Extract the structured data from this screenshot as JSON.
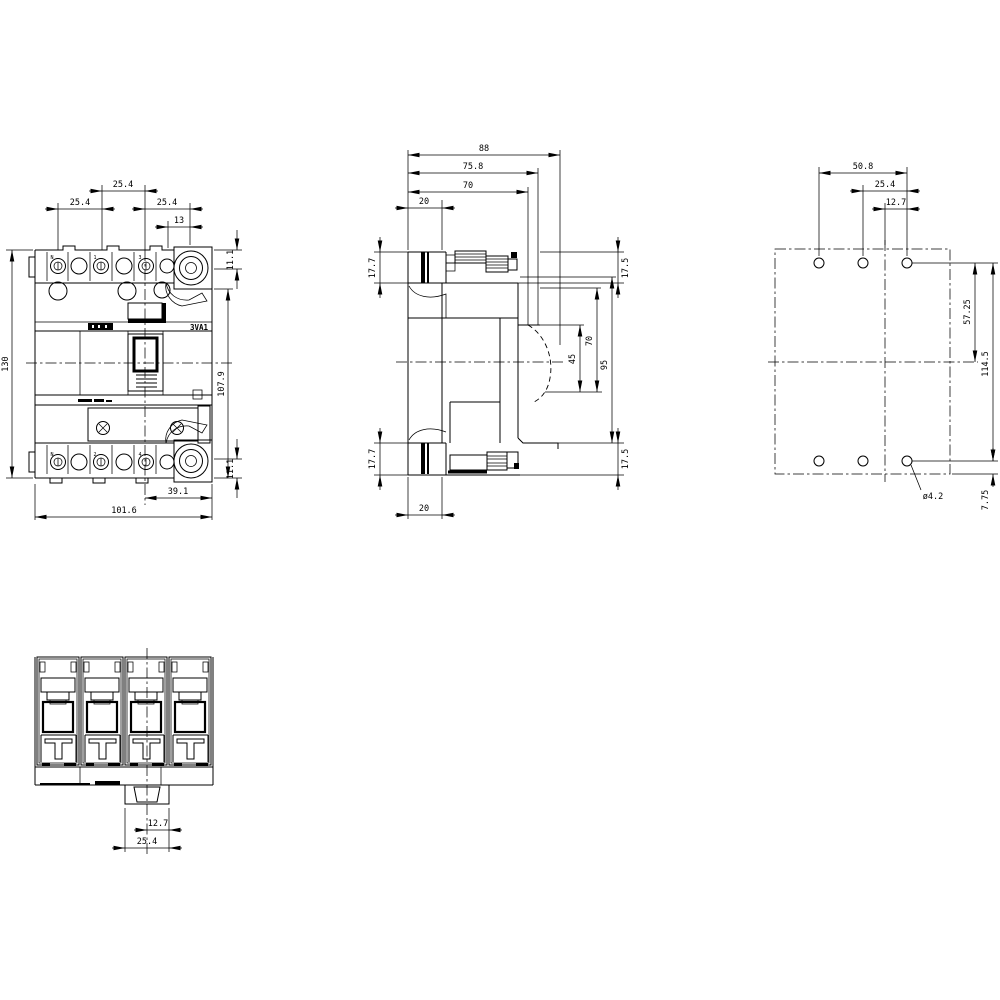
{
  "drawing": {
    "product_label": "3VA1"
  },
  "dims": {
    "front": {
      "pitch_top": "25.4",
      "pitch_left": "25.4",
      "pitch_right": "25.4",
      "rotary_offset": "13",
      "rotary_height_top": "11.1",
      "rotary_height_bottom": "11.1",
      "overall_height": "130",
      "face_height": "107.9",
      "bottom_offset": "39.1",
      "overall_width": "101.6"
    },
    "side": {
      "overall_depth": "88",
      "escutcheon_depth": "75.8",
      "front_depth": "70",
      "terminal_depth_top": "20",
      "terminal_depth_bottom": "20",
      "terminal_height_top": "17.7",
      "terminal_height_bottom": "17.7",
      "step_height_top": "17.5",
      "step_height_bottom": "17.5",
      "handle_depth": "45",
      "cover_depth": "70",
      "front_height": "95"
    },
    "rear": {
      "hole_span_outer": "50.8",
      "hole_span_inner": "25.4",
      "hole_span_half": "12.7",
      "upper_hole_height": "57.25",
      "hole_row_height": "114.5",
      "lower_hole_offset": "7.75",
      "hole_diameter": "ø4.2"
    },
    "bottom": {
      "tab_half_width": "12.7",
      "tab_width": "25.4"
    }
  },
  "pole_markers": {
    "top": [
      "N",
      "1",
      "3"
    ],
    "bottom": [
      "N",
      "2",
      "4"
    ]
  }
}
